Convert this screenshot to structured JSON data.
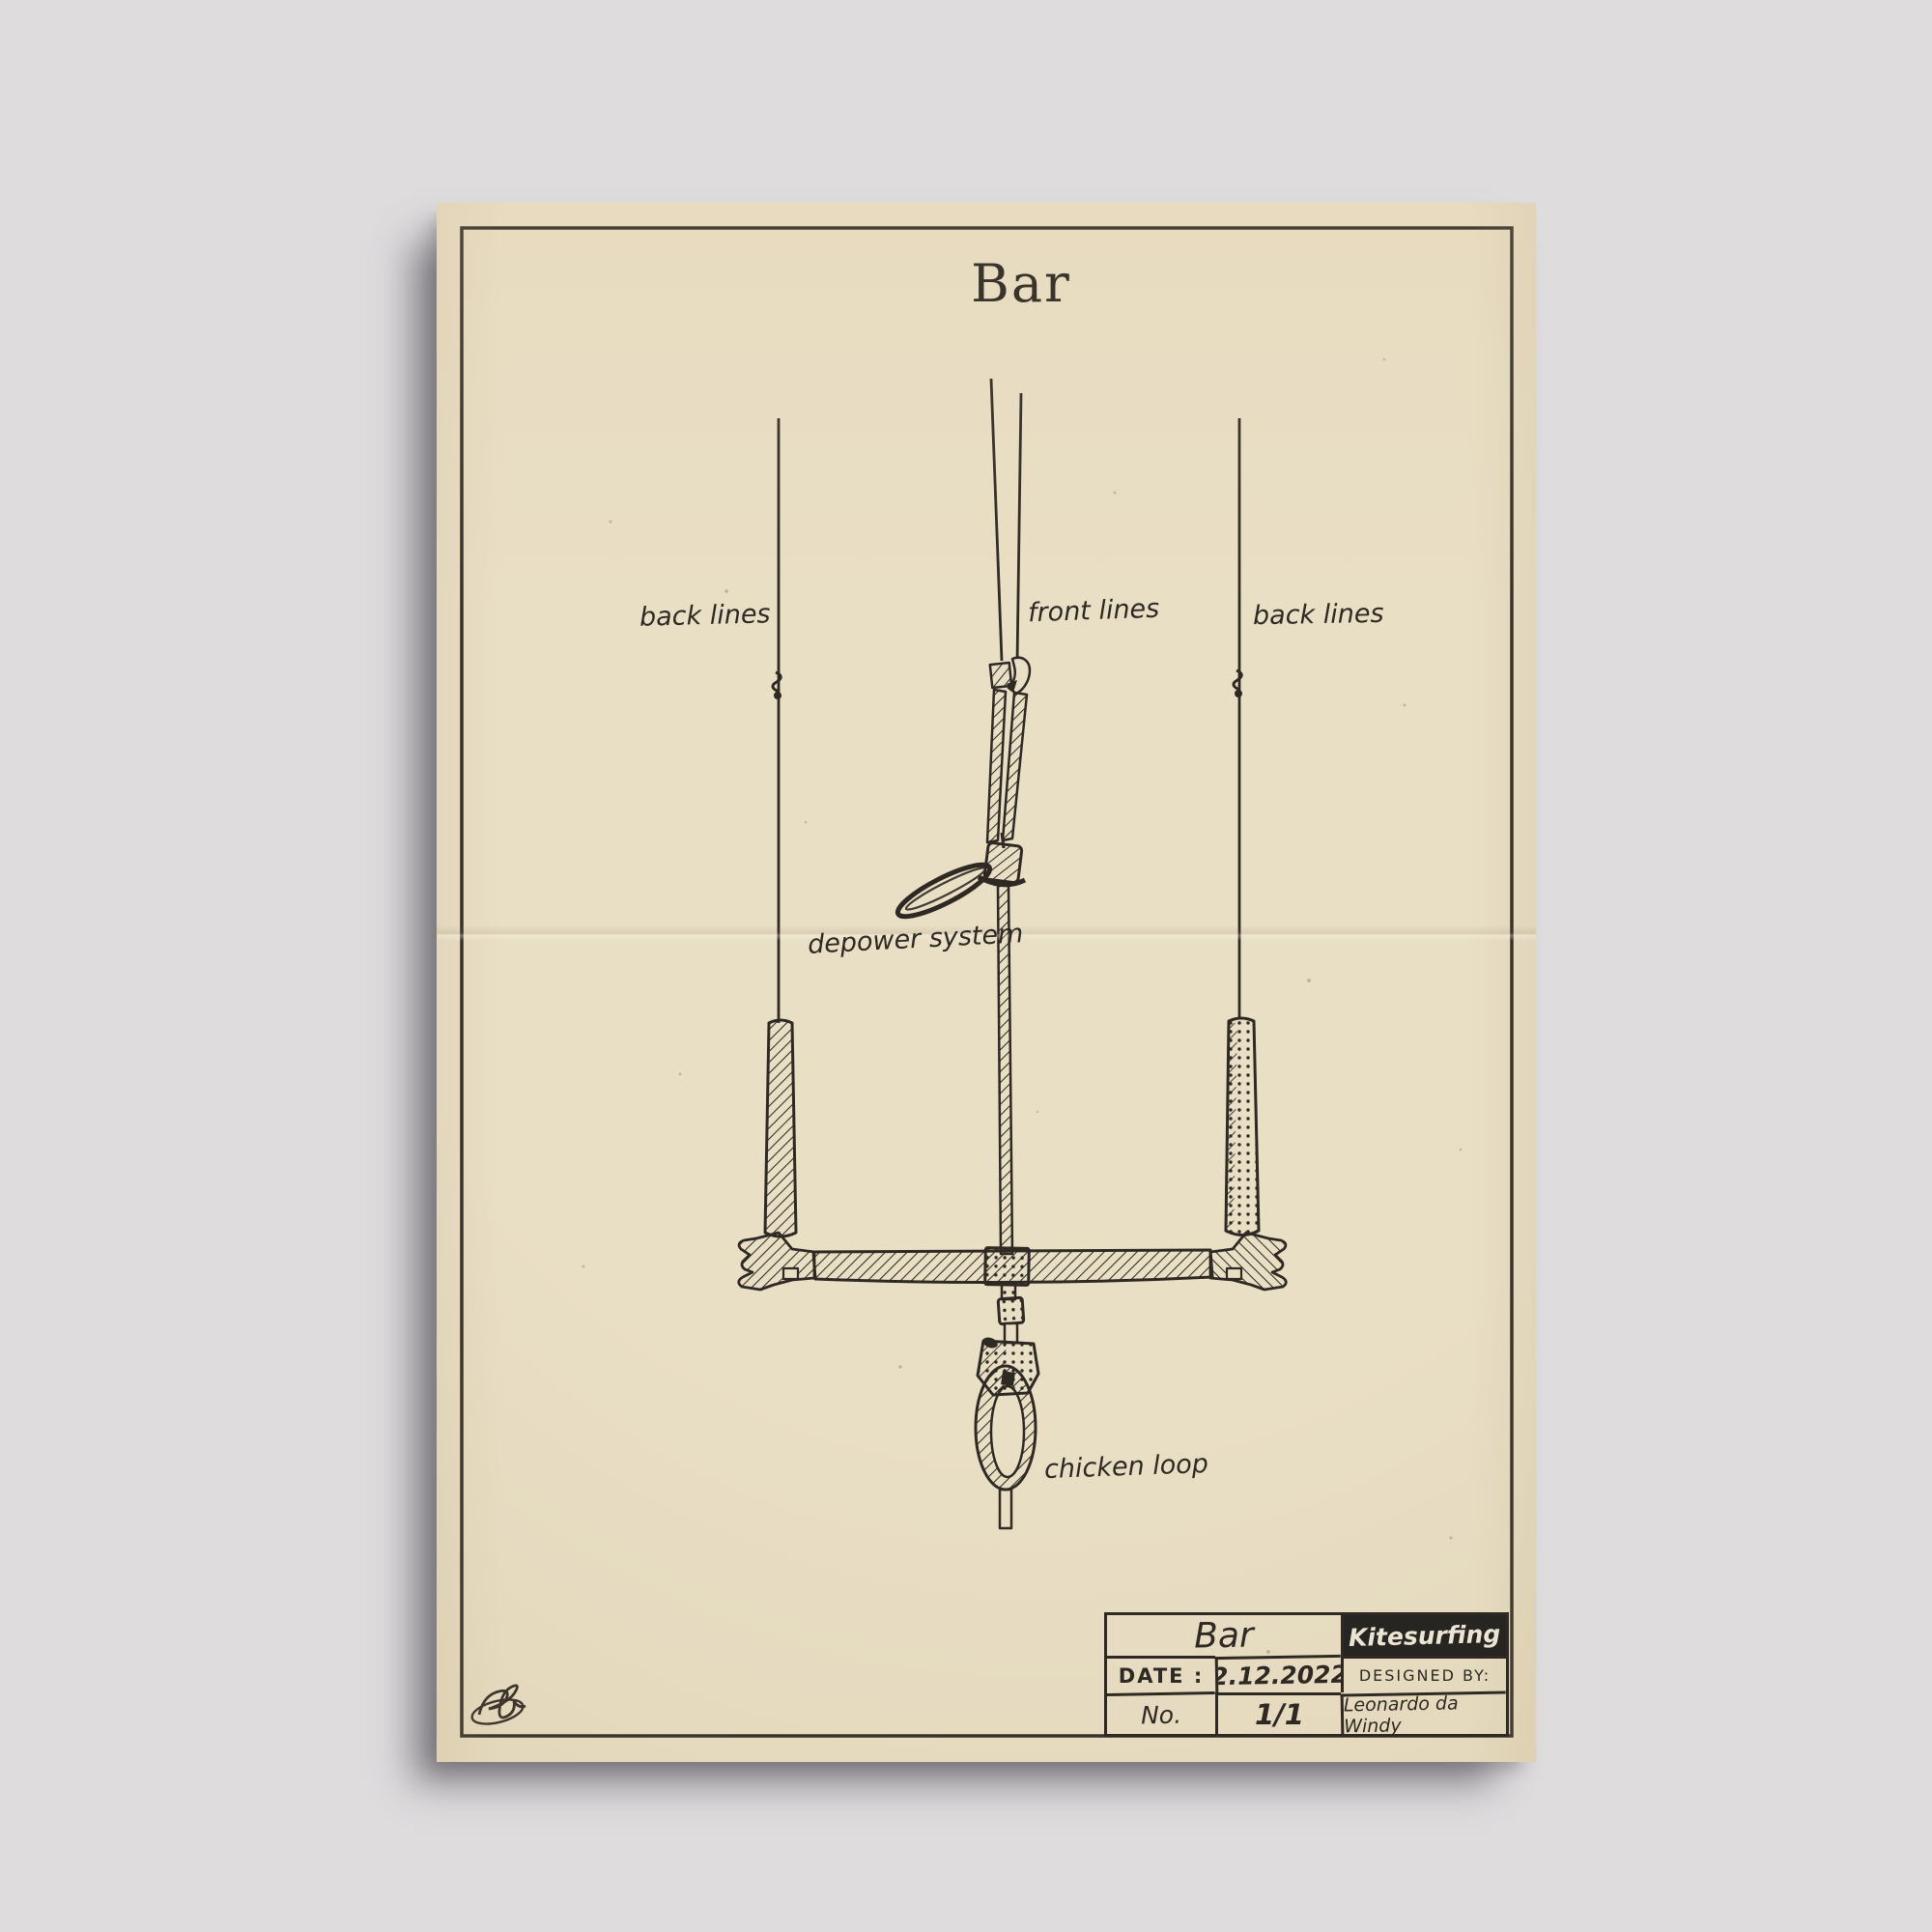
{
  "poster": {
    "title": "Bar",
    "diagram_labels": {
      "back_lines_left": "back lines",
      "front_lines": "front lines",
      "back_lines_right": "back lines",
      "depower_system": "depower system",
      "chicken_loop": "chicken loop"
    },
    "title_block": {
      "name": "Bar",
      "category": "Kitesurfing",
      "date_label": "DATE :",
      "date_value": "2.12.2022",
      "designed_by_label": "DESIGNED BY:",
      "designed_by_value": "Leonardo da Windy",
      "number_label": "No.",
      "number_value": "1/1"
    },
    "colors": {
      "background": "#dedcdd",
      "paper": "#e9dfc5",
      "ink": "#2e2a23",
      "category_bg": "#272521",
      "category_text": "#ece5d3"
    }
  }
}
